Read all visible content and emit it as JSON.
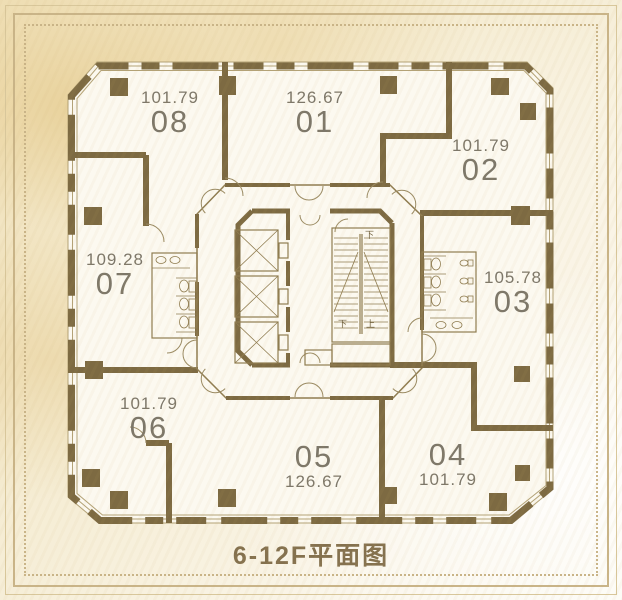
{
  "title": "6-12F平面图",
  "units": [
    {
      "id": "01",
      "area": "126.67"
    },
    {
      "id": "02",
      "area": "101.79"
    },
    {
      "id": "03",
      "area": "105.78"
    },
    {
      "id": "04",
      "area": "101.79"
    },
    {
      "id": "05",
      "area": "126.67"
    },
    {
      "id": "06",
      "area": "101.79"
    },
    {
      "id": "07",
      "area": "109.28"
    },
    {
      "id": "08",
      "area": "101.79"
    }
  ],
  "stairs": {
    "down": "下",
    "up": "上"
  },
  "colors": {
    "wall": "#7d6a42",
    "thin": "#8f7c50",
    "frame": "#c9b488",
    "text": "#7d7769",
    "title": "#84714e",
    "floor": "#fcf9f0",
    "paper": "#f4e9cb"
  }
}
